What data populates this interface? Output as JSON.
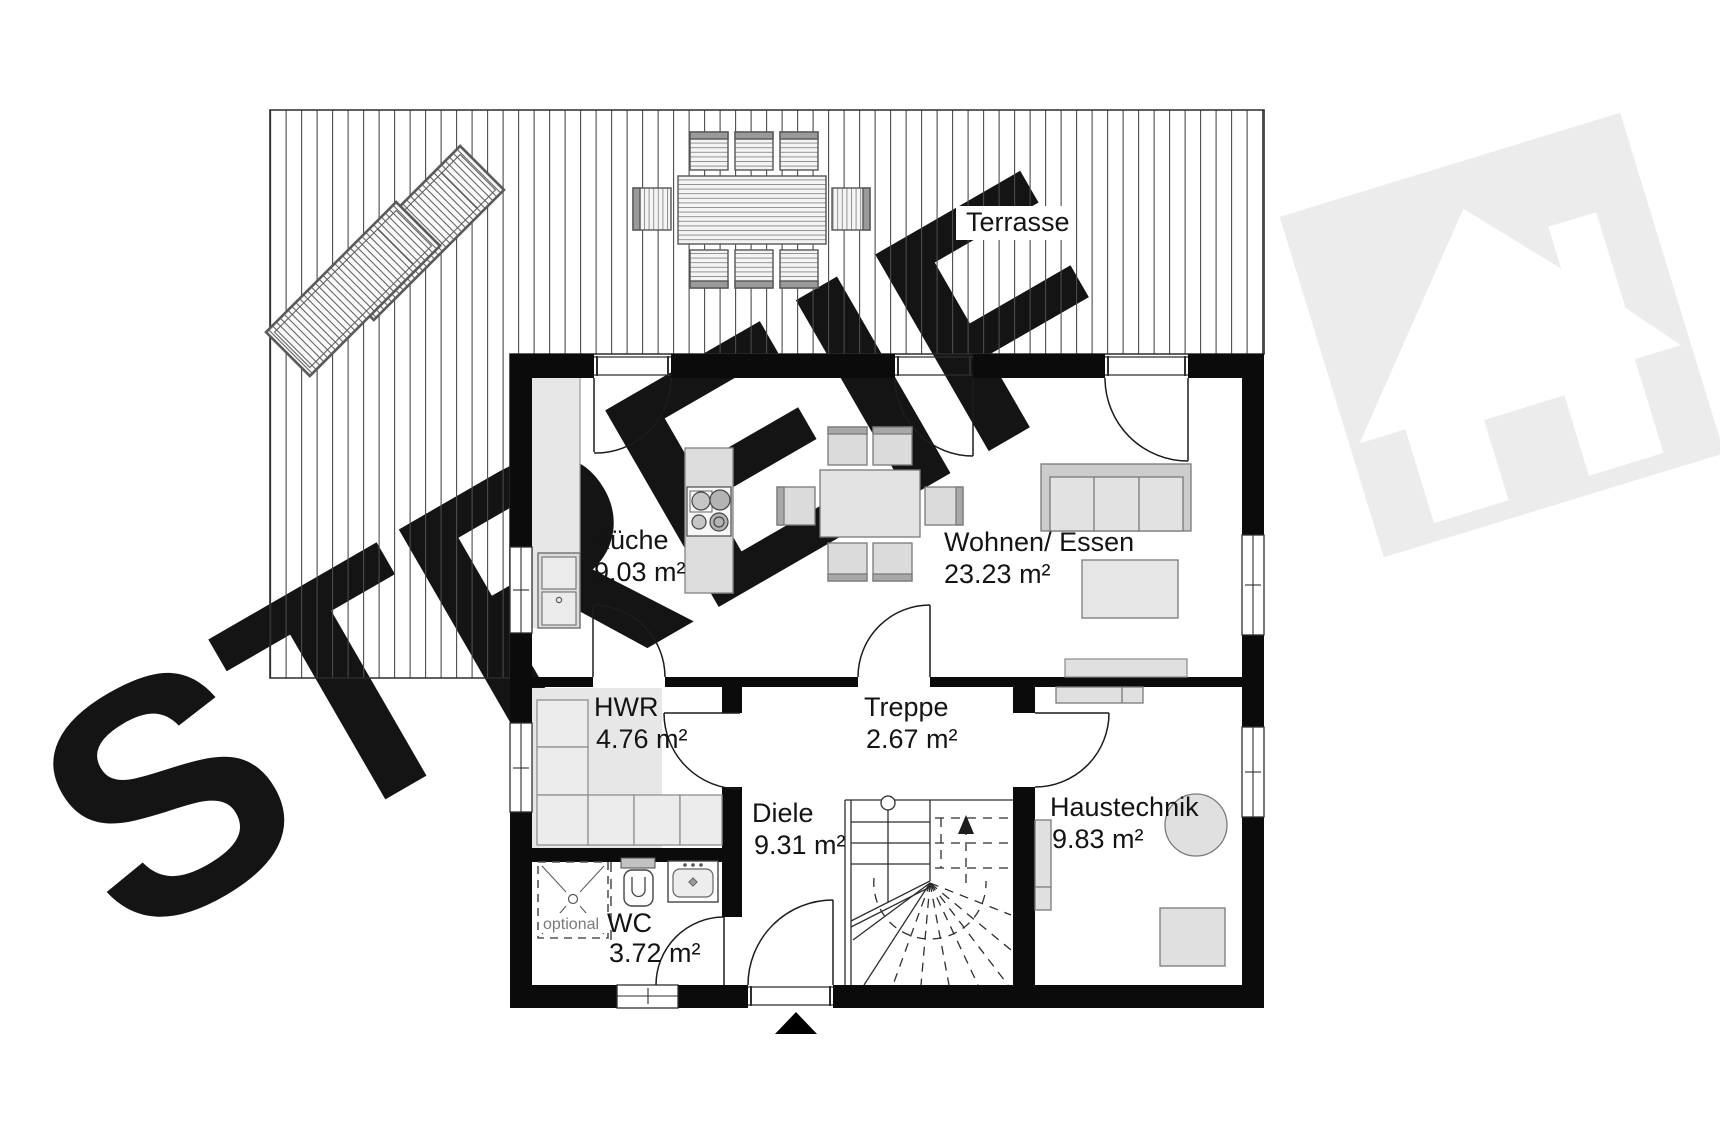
{
  "watermark": {
    "text": "STREIF",
    "color": "#eeeeee"
  },
  "terrace": {
    "label": "Terrasse"
  },
  "rooms": {
    "kueche": {
      "name": "Küche",
      "area": "9.03 m²"
    },
    "wohnen": {
      "name": "Wohnen/ Essen",
      "area": "23.23 m²"
    },
    "hwr": {
      "name": "HWR",
      "area": "4.76 m²"
    },
    "treppe": {
      "name": "Treppe",
      "area": "2.67 m²"
    },
    "diele": {
      "name": "Diele",
      "area": "9.31 m²"
    },
    "haustechnik": {
      "name": "Haustechnik",
      "area": "9.83 m²"
    },
    "wc": {
      "name": "WC",
      "area": "3.72 m²"
    }
  },
  "annotations": {
    "optional_label": "optional"
  },
  "colors": {
    "wall": "#0b0b0b",
    "line": "#2e2e2e",
    "floor_gray": "#e7e7e7",
    "furniture_fill": "#e0e0e0",
    "furniture_accent": "#a8a8a8",
    "watermark_gray": "#ededed"
  }
}
